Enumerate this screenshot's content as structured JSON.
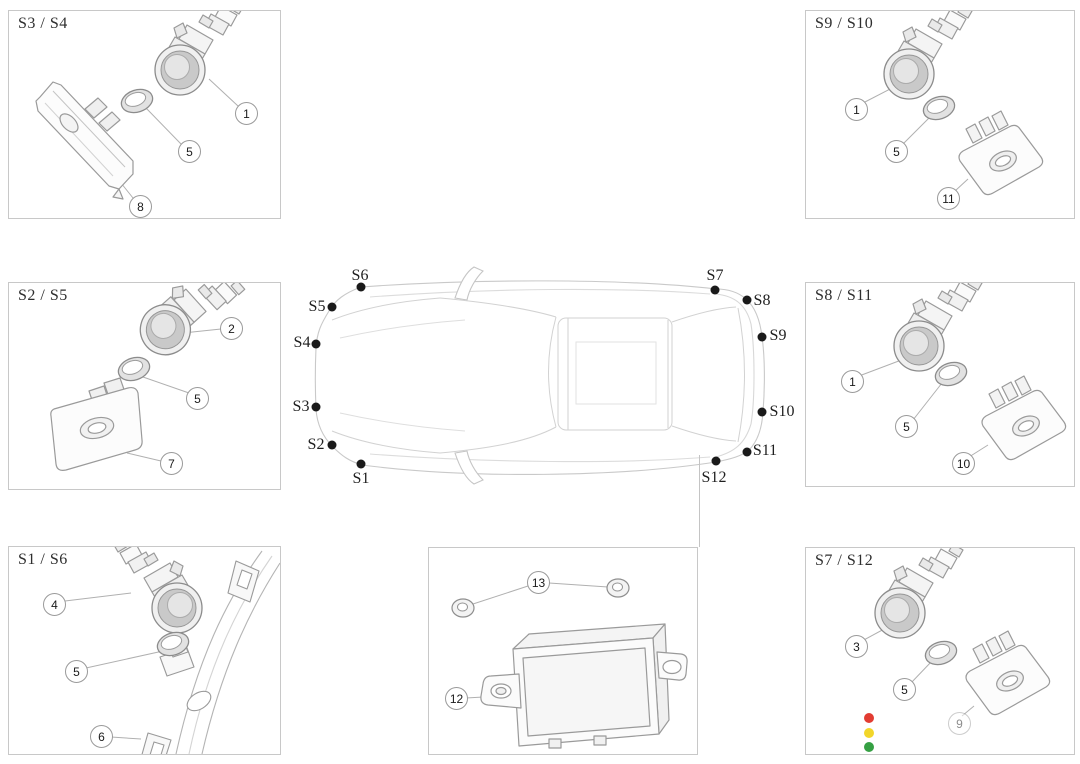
{
  "panels": {
    "s3_s4": {
      "title": "S3 / S4",
      "callouts": {
        "sensor": "1",
        "grommet": "5",
        "bracket": "8"
      }
    },
    "s9_s10": {
      "title": "S9 / S10",
      "callouts": {
        "sensor": "1",
        "grommet": "5",
        "bracket": "11"
      }
    },
    "s2_s5": {
      "title": "S2 / S5",
      "callouts": {
        "sensor": "2",
        "grommet": "5",
        "bracket": "7"
      }
    },
    "s8_s11": {
      "title": "S8 / S11",
      "callouts": {
        "sensor": "1",
        "grommet": "5",
        "bracket": "10"
      }
    },
    "s1_s6": {
      "title": "S1 / S6",
      "callouts": {
        "sensor": "4",
        "grommet": "5",
        "bumper": "6"
      }
    },
    "control_module": {
      "callouts": {
        "module": "12",
        "nut": "13"
      }
    },
    "s7_s12": {
      "title": "S7 / S12",
      "callouts": {
        "sensor": "3",
        "grommet": "5",
        "bracket": "9"
      }
    }
  },
  "car": {
    "labels": [
      "S1",
      "S2",
      "S3",
      "S4",
      "S5",
      "S6",
      "S7",
      "S8",
      "S9",
      "S10",
      "S11",
      "S12"
    ]
  },
  "legend_dots": [
    {
      "name": "red",
      "color": "#e23c32"
    },
    {
      "name": "yellow",
      "color": "#f2d62a"
    },
    {
      "name": "green",
      "color": "#35a043"
    }
  ]
}
